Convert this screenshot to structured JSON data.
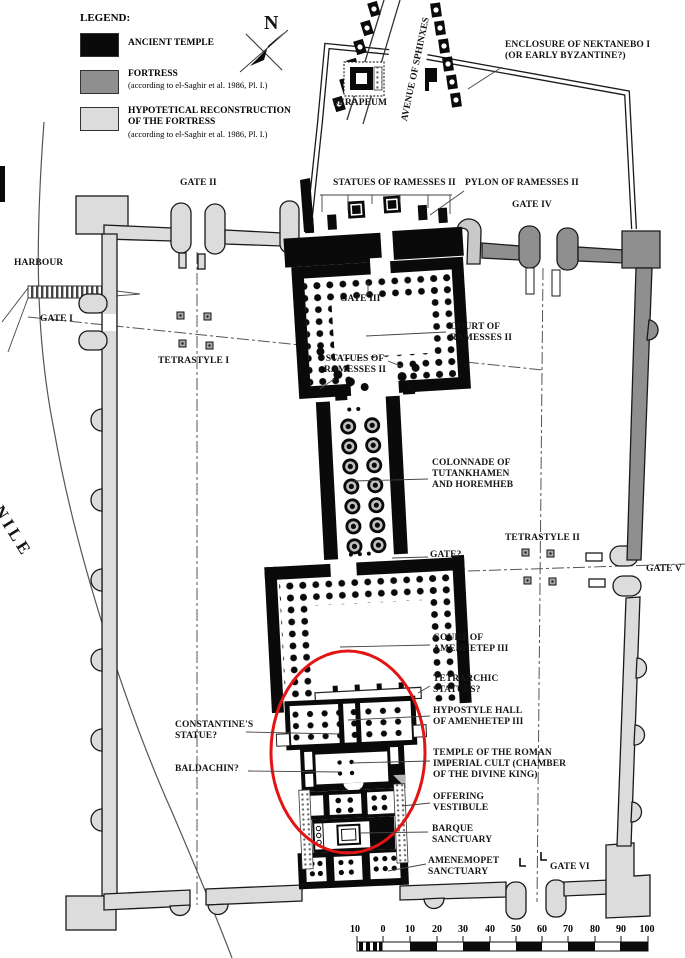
{
  "figure_type": "archaeological site plan",
  "legend": {
    "title": "LEGEND:",
    "items": [
      {
        "label": "ANCIENT TEMPLE",
        "note": "",
        "color": "#0a0a0a"
      },
      {
        "label": "FORTRESS",
        "note": "(according to el-Saghir et al. 1986, Pl. I.)",
        "color": "#8f8f8f"
      },
      {
        "label": "HYPOTETICAL RECONSTRUCTION\nOF THE FORTRESS",
        "note": "(according to el-Saghir et al. 1986, Pl. I.)",
        "color": "#dcdcdc"
      }
    ]
  },
  "compass": {
    "label": "N"
  },
  "labels": {
    "harbour": "HARBOUR",
    "nile": "NILE",
    "gate_i": "GATE I",
    "gate_ii": "GATE II",
    "gate_iii": "GATE III",
    "gate_iv": "GATE IV",
    "gate_v": "GATE V",
    "gate_vi": "GATE VI",
    "gate_unknown": "GATE?",
    "avenue_of_sphinxes": "AVENUE OF SPHINXES",
    "serapeum": "SERAPEUM",
    "enclosure": "ENCLOSURE OF NEKTANEBO I\n(OR EARLY BYZANTINE?)",
    "statues_of_ramesses_top": "STATUES OF RAMESSES II",
    "pylon_of_ramesses": "PYLON OF RAMESSES II",
    "court_of_ramesses": "COURT OF\nRAMESSES II",
    "statues_of_ramesses_court": "STATUES OF\nRAMESSES II",
    "tetrastyle_i": "TETRASTYLE I",
    "tetrastyle_ii": "TETRASTYLE II",
    "colonnade": "COLONNADE OF\nTUTANKHAMEN\nAND HOREMHEB",
    "court_of_amenhetep": "COURT OF\nAMENHETEP III",
    "tetrarchic_statues": "TETRARCHIC\nSTATUES?",
    "constantines_statue": "CONSTANTINE'S\nSTATUE?",
    "hypostyle_hall": "HYPOSTYLE HALL\nOF AMENHETEP III",
    "roman_imperial_cult": "TEMPLE OF THE ROMAN\nIMPERIAL CULT (CHAMBER\nOF THE DIVINE KING)",
    "baldachin": "BALDACHIN?",
    "offering_vestibule": "OFFERING\nVESTIBULE",
    "barque_sanctuary": "BARQUE\nSANCTUARY",
    "amenemopet_sanctuary": "AMENEMOPET\nSANCTUARY"
  },
  "scale_bar": {
    "ticks": [
      "10",
      "0",
      "10",
      "20",
      "30",
      "40",
      "50",
      "60",
      "70",
      "80",
      "90",
      "100"
    ]
  },
  "colors": {
    "ancient_temple": "#0a0a0a",
    "fortress": "#8f8f8f",
    "fortress_reconstruction": "#dcdcdc",
    "highlight_ellipse": "#e21414"
  }
}
